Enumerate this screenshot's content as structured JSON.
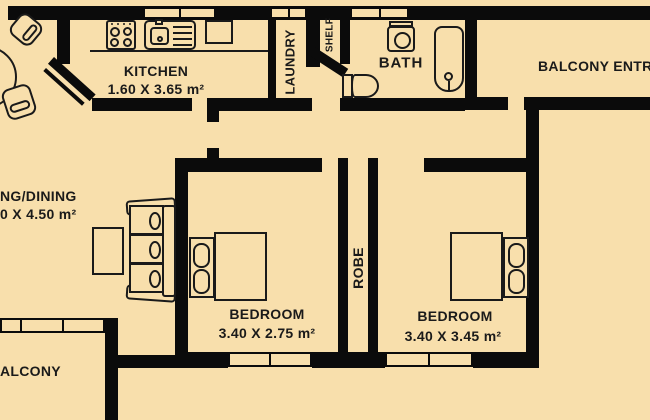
{
  "title": "apartment floor plan",
  "colors": {
    "background": "#F8DFAC",
    "wall": "#0B0B0B",
    "line": "#1A1A1A",
    "text": "#1A1A1A"
  },
  "rooms": {
    "kitchen": {
      "label": "KITCHEN",
      "dims": "1.60 X 3.65 m²"
    },
    "laundry": {
      "label": "LAUNDRY"
    },
    "shelf": {
      "label": "SHELF"
    },
    "bath": {
      "label": "BATH"
    },
    "balcony_entry": {
      "label": "BALCONY ENTR"
    },
    "living_dining": {
      "label": "NG/DINING",
      "dims": "0 X 4.50 m²"
    },
    "bedroom_1": {
      "label": "BEDROOM",
      "dims": "3.40 X 2.75 m²"
    },
    "robe": {
      "label": "ROBE"
    },
    "bedroom_2": {
      "label": "BEDROOM",
      "dims": "3.40 X 3.45 m²"
    },
    "balcony": {
      "label": "ALCONY"
    }
  },
  "furniture": [
    "stove",
    "kitchen-sink",
    "counter",
    "dining-table",
    "dining-chairs",
    "sofa",
    "coffee-table",
    "double-bed-1",
    "double-bed-2",
    "toilet",
    "washbasin",
    "bathtub",
    "windows"
  ]
}
